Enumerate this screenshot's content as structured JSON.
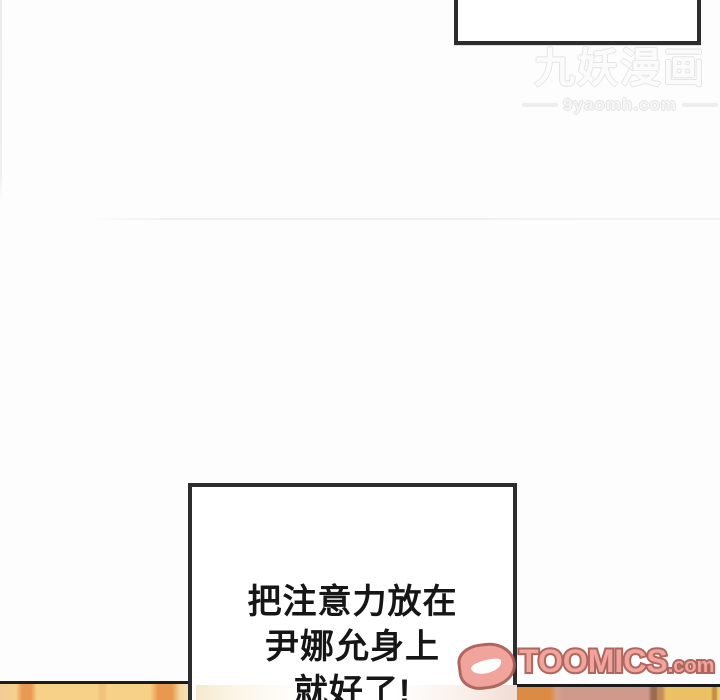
{
  "watermark": {
    "title": "九妖漫画",
    "site": "9yaomh.com"
  },
  "speech": {
    "lines": [
      "把注意力放在",
      "尹娜允身上",
      "就好了!"
    ]
  },
  "toomics": {
    "brand": "TOOMICS",
    "tld": ".com",
    "logo_icon": "smiling-d-mascot"
  },
  "colors": {
    "page_bg": "#fdfdfd",
    "bubble_fill": "#ffffff",
    "bubble_border": "#2d2d2d",
    "text_black": "#161616",
    "watermark_gray": "#e4e4e4",
    "panel_line": "#1b1b1b",
    "toomics_pink": "#ef9d94",
    "toomics_outline": "#a85b52",
    "strip_left_base": "#f8d189",
    "strip_left_stripe": "#e99a52",
    "strip_orange": "#db8b43",
    "strip_pink": "#cf9a8b",
    "strip_yellow": "#ecc163"
  }
}
